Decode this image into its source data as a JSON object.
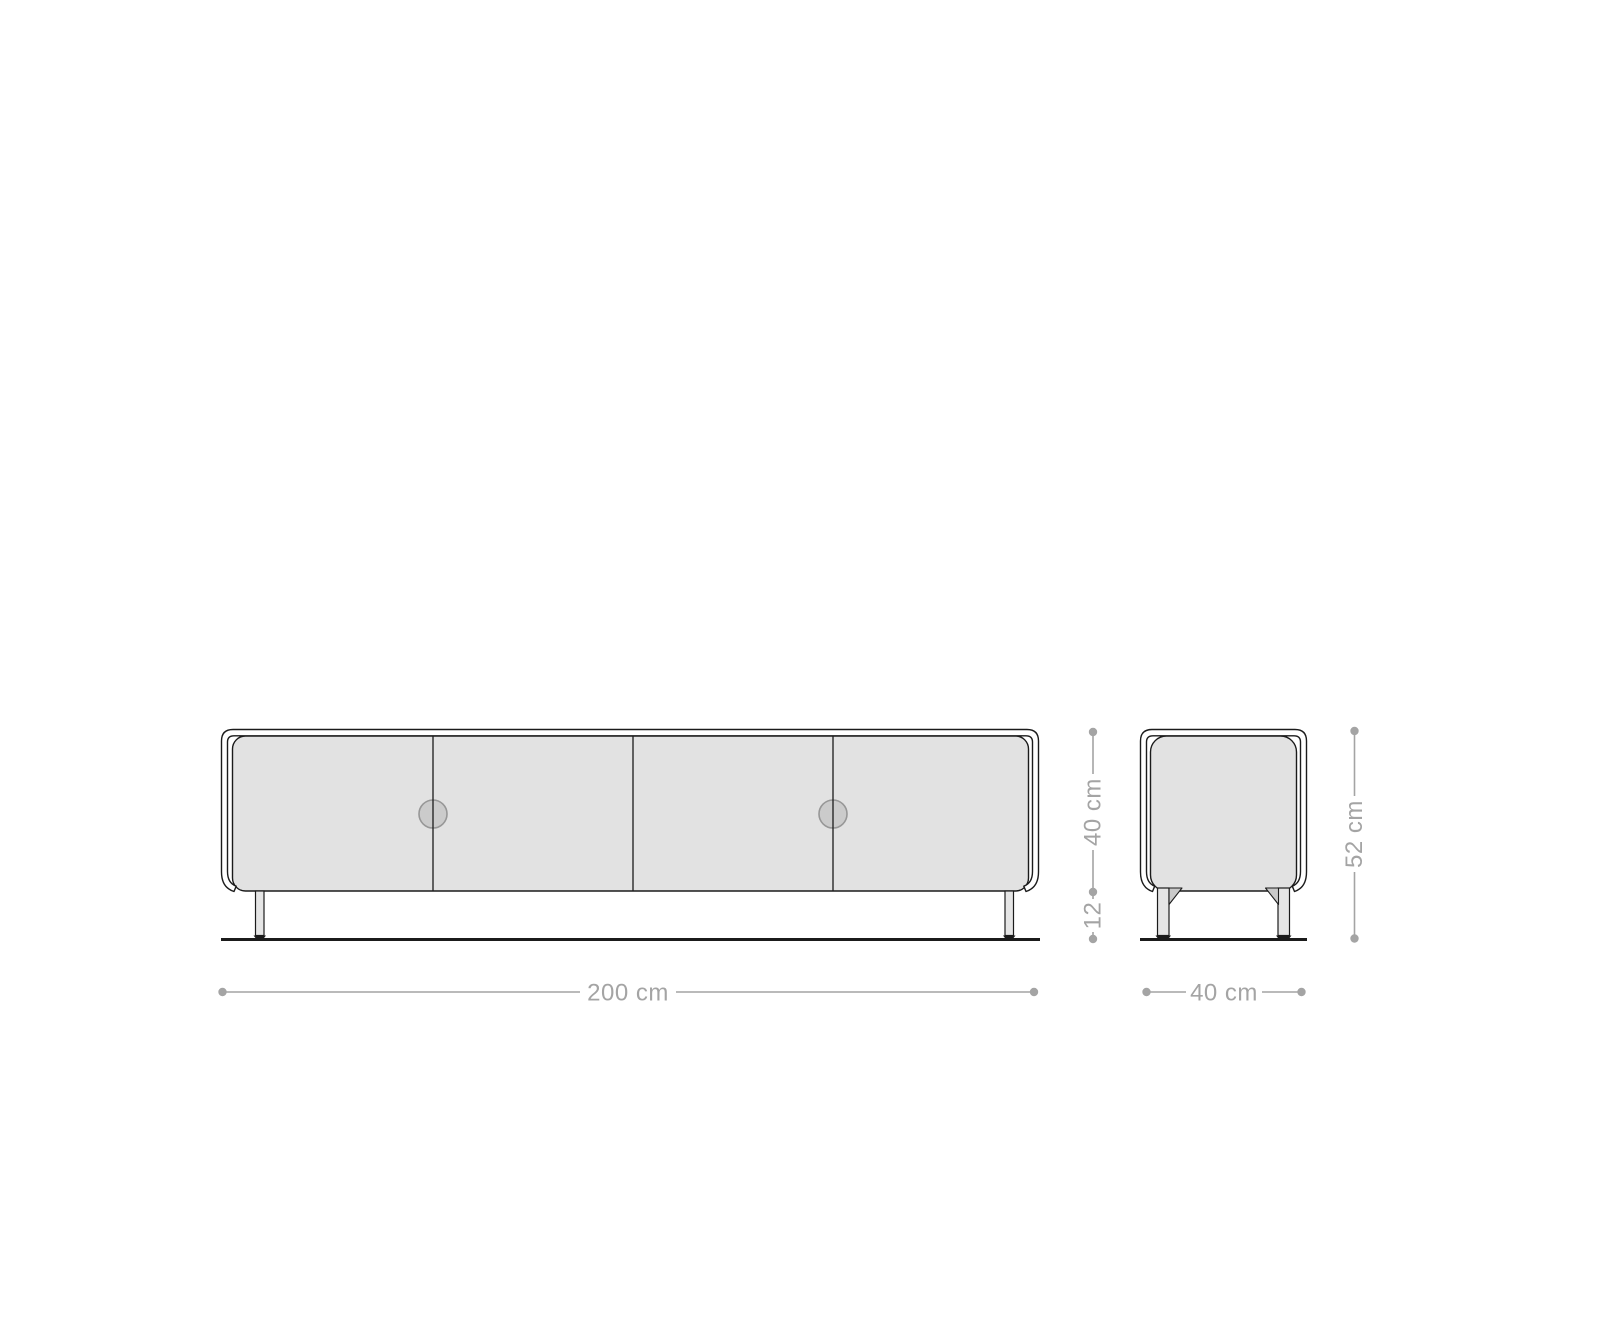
{
  "diagram": {
    "type": "furniture-dimension-drawing",
    "subject": "lowboard-sideboard-with-4-doors",
    "front_view": {
      "label": "front",
      "door_count": 4,
      "handle_count": 2,
      "width": {
        "label": "200 cm"
      }
    },
    "side_view": {
      "label": "side",
      "depth": {
        "label": "40 cm"
      },
      "body_height": {
        "label": "40 cm"
      },
      "leg_height": {
        "label": "12"
      },
      "total_height": {
        "label": "52 cm"
      }
    }
  },
  "colors": {
    "background": "#ffffff",
    "outline": "#1b1b1b",
    "panel_fill": "#e2e2e2",
    "leg_fill": "#e5e5e5",
    "bracket_fill": "#c9c9c9",
    "handle_fill": "#cbcbcb",
    "handle_stroke": "#979797",
    "dimension": "#a4a4a4"
  }
}
